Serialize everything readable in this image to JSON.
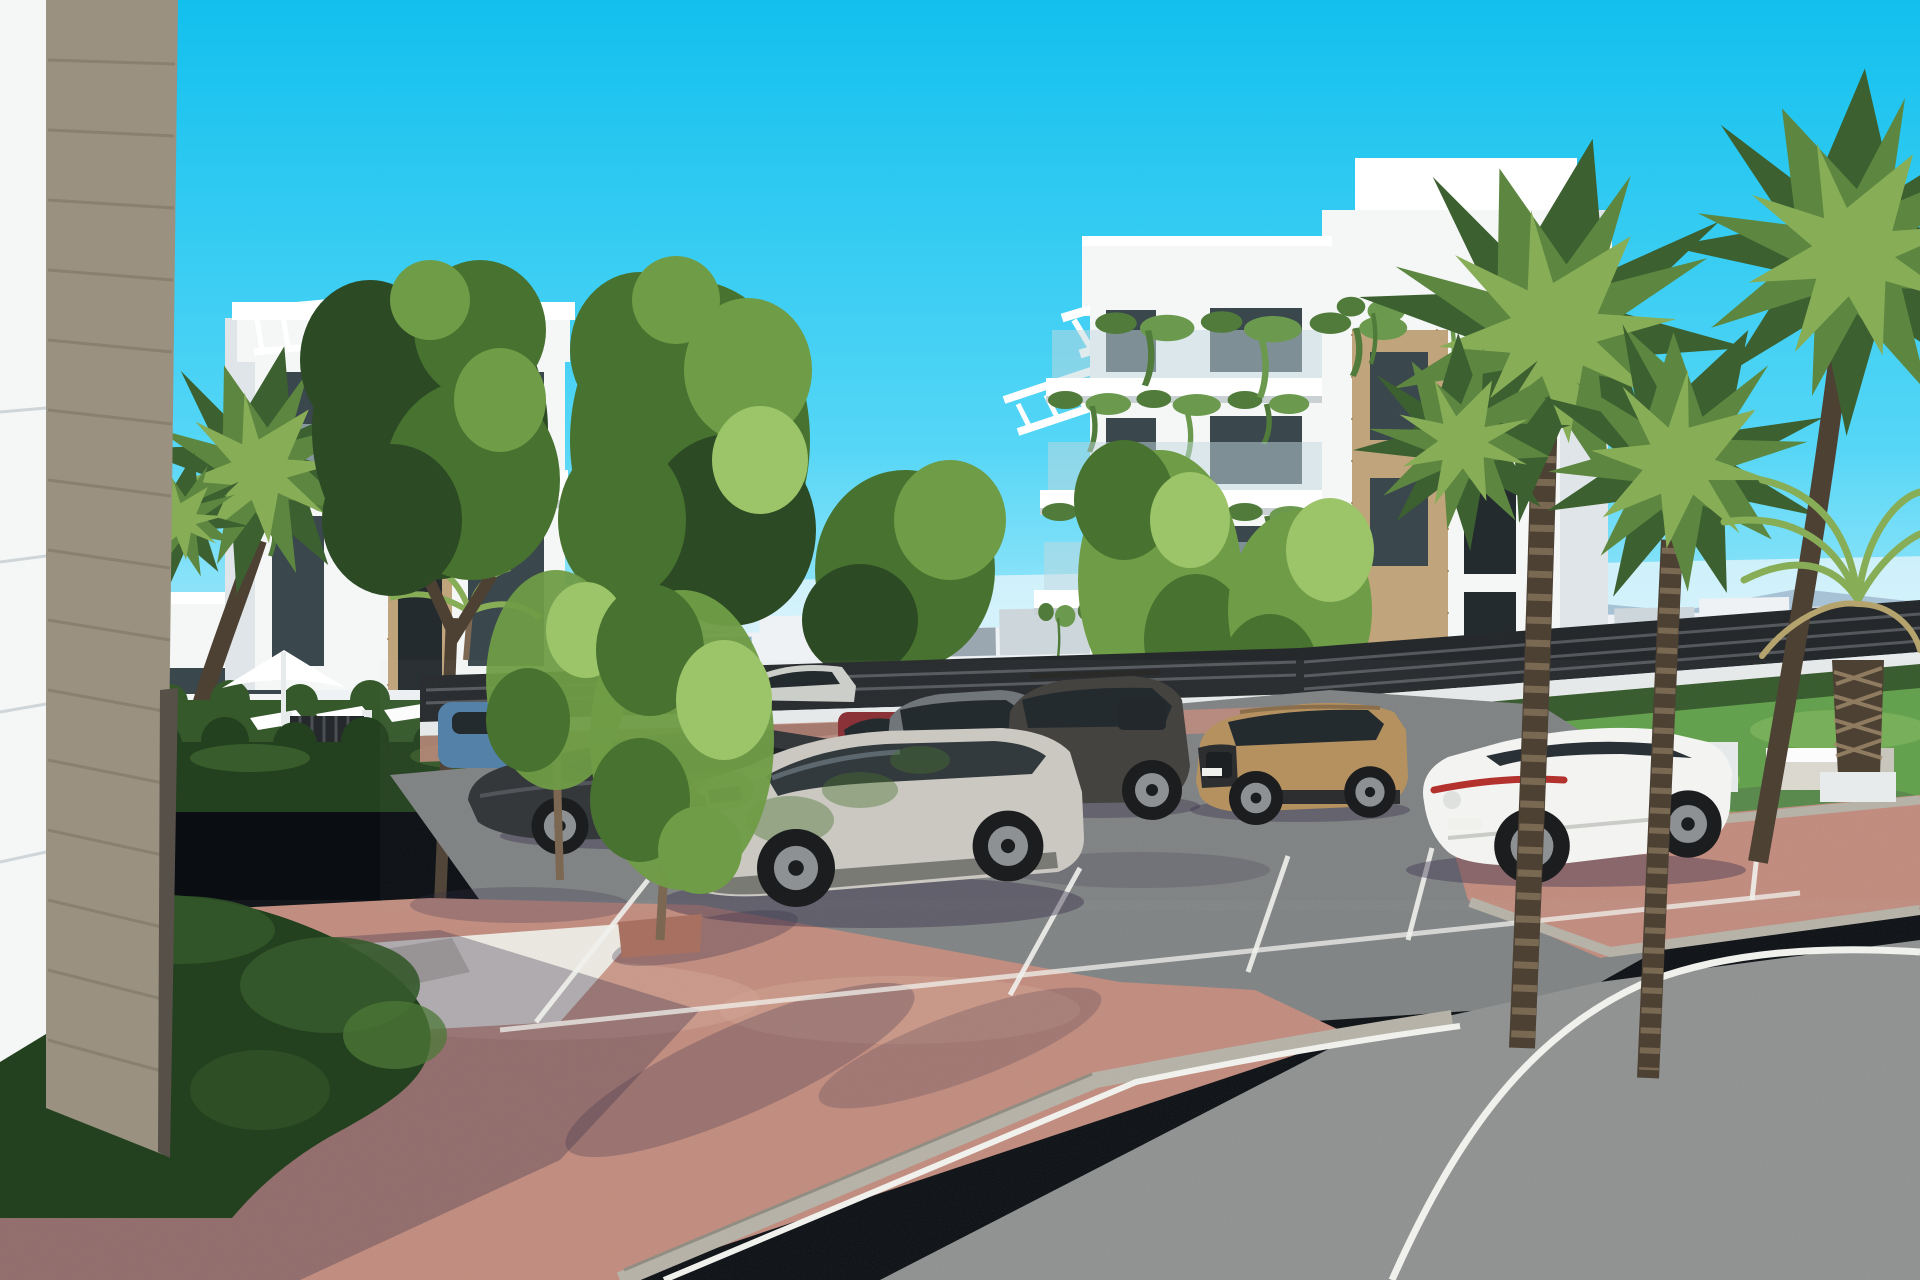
{
  "meta": {
    "type": "architectural-3d-exterior-render",
    "description": "New-build white apartment complex with parking bays, curved asphalt road, terracotta brick paving, hedges and palm trees under a clear cyan sky",
    "canvas": {
      "width": 1920,
      "height": 1280
    },
    "visible_text": "none"
  },
  "palette": {
    "sky_top": "#12c0ee",
    "sky_mid": "#55d6f6",
    "sky_low": "#bdeffc",
    "haze": "#e8f6fb",
    "mountain": "#a3bdd0",
    "town_light": "#eef2f4",
    "town_mid": "#cdd6db",
    "town_dark": "#9aa7b0",
    "town_blue": "#8fb3cc",
    "fence_dark": "#26292c",
    "base_wall": "#e8ebeb",
    "wall": "#f5f7f7",
    "wall_shade": "#dfe5e8",
    "wall_dark": "#c9d1d5",
    "slab": "#ffffff",
    "stone": "#c0a47c",
    "stone_dark": "#a68a60",
    "pier": "#9a9180",
    "pier_dark": "#857c6b",
    "pier_edge": "#565049",
    "win": "#3a474d",
    "win_dark": "#242b2f",
    "glass": "#64787f",
    "rail": "#c2d8de",
    "hang_green": "#6b9a4e",
    "hang_dark": "#507b3a",
    "tree_dark": "#2c4a24",
    "tree_mid": "#47722f",
    "tree_light": "#6f9c46",
    "tree_hi": "#9cc468",
    "palm_dark": "#3c6030",
    "palm_mid": "#5d8740",
    "palm_light": "#88ad57",
    "palm_dry": "#b5a36d",
    "trunk": "#7c6852",
    "trunk_dark": "#4d4134",
    "trunk_light": "#a08a6b",
    "grass": "#61a04b",
    "grass_hi": "#83b95e",
    "hedge_dark": "#23411e",
    "hedge_mid": "#35592b",
    "hedge_hi": "#4d7838",
    "brick": "#c18b7d",
    "brick_hi": "#d2a493",
    "brick_dark": "#a87061",
    "gravel": "#edeae3",
    "curb": "#b6b2a7",
    "ramp": "#c9c5bb",
    "asphalt": "#8f9191",
    "asphalt_park": "#7f8283",
    "line": "#f0f0ec",
    "car_silver": "#ccceca",
    "car_white": "#f3f4f2",
    "car_dark": "#35383b",
    "car_gray": "#70767a",
    "car_red": "#8a3238",
    "car_tan": "#b69160",
    "car_blue": "#5381a8",
    "tire": "#1b1d1f",
    "rim": "#8d9194",
    "shadow": "#36304a",
    "trunk_lt": "#a08a6b"
  },
  "scene": {
    "sky": {
      "label": "clear cyan sky, light toward horizon"
    },
    "background": {
      "mountains": "pale blue mountain ridge on horizon",
      "town": "distant low-rise white town strip",
      "cranes": 2
    },
    "buildings": [
      {
        "id": "foreground-corner",
        "label": "close-up building corner: white panel wall and travertine pier"
      },
      {
        "id": "left-building",
        "label": "white 4-storey apartment block with roof pergola, stone inset and hanging planters"
      },
      {
        "id": "right-building",
        "label": "white 4-storey apartment block with stepped balconies, roof trellises, stone piers and hanging greenery"
      }
    ],
    "amenities": [
      "white pool parasol",
      "three white sun loungers",
      "dark slatted pool gate",
      "perimeter slat fence on white base wall",
      "concrete bench on lawn",
      "white planter cube"
    ],
    "vegetation": {
      "fan_palms": 5,
      "date_palm": 1,
      "deciduous_trees": 7,
      "saplings": 2,
      "hedges": "clipped hedge rows behind parking bays, around pool deck and large sculpted hedge mound at lower left",
      "lawn": "sunlit grass with pale patches on the right"
    },
    "vehicles": [
      {
        "id": "car-passing-silver",
        "label": "silver car passing behind perimeter fence",
        "color": "car_silver"
      },
      {
        "id": "compact-blue",
        "label": "blue compact car in far-left bay",
        "color": "car_blue"
      },
      {
        "id": "sedan-dark",
        "label": "dark grey sedan",
        "color": "car_dark"
      },
      {
        "id": "hatchback-red",
        "label": "dark red hatchback",
        "color": "car_red"
      },
      {
        "id": "suv-grey",
        "label": "grey SUV",
        "color": "car_gray"
      },
      {
        "id": "suv-dark",
        "label": "dark grey-brown SUV",
        "color": "car_dark"
      },
      {
        "id": "suv-tan",
        "label": "sand-beige compact SUV",
        "color": "car_tan"
      },
      {
        "id": "sedan-white",
        "label": "white fastback sedan",
        "color": "car_white"
      },
      {
        "id": "suv-hero-silver",
        "label": "light grey SUV in foreground bay under dappled tree shade",
        "color": "car_silver"
      }
    ],
    "ground": [
      "terracotta brick paved plaza with long tree shadows",
      "white gravel planting bed",
      "grey concrete access ramp",
      "asphalt parking bays with white stall markings",
      "curved asphalt road with white edge line and grey curb"
    ]
  }
}
